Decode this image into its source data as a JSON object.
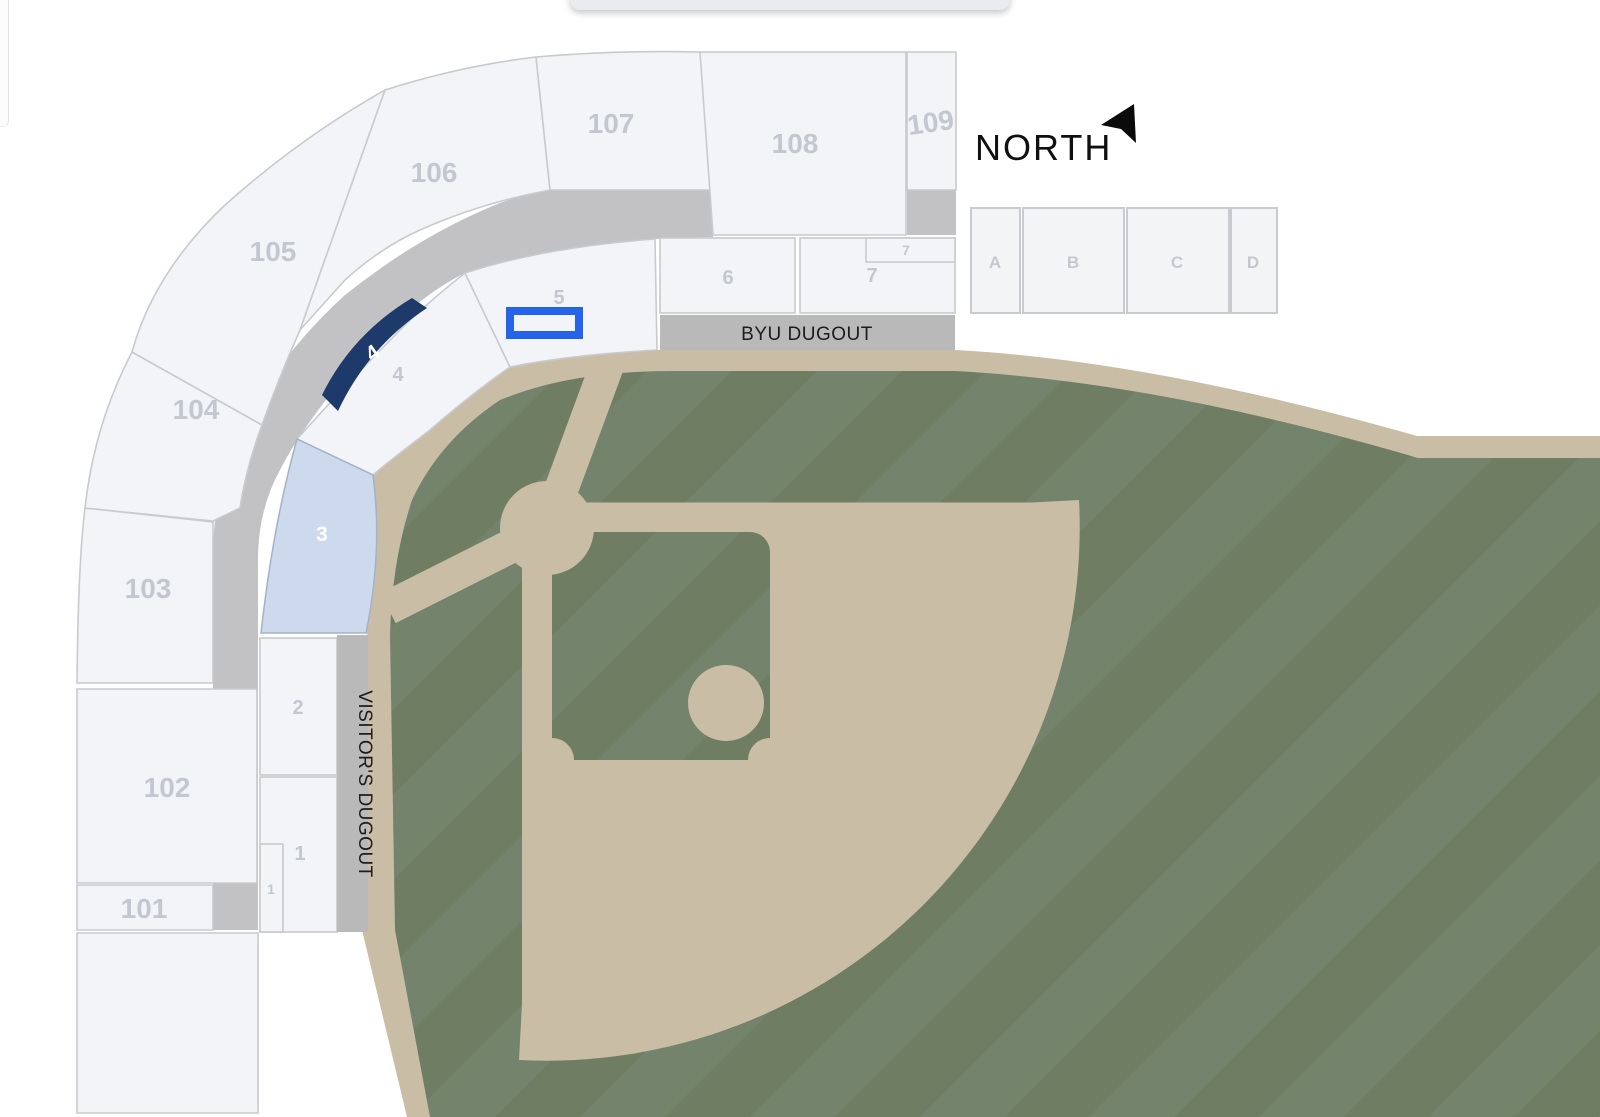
{
  "compass": {
    "label": "NORTH"
  },
  "dugouts": {
    "byu": "BYU DUGOUT",
    "visitor": "VISITOR'S DUGOUT"
  },
  "outer_sections": {
    "s101": "101",
    "s102": "102",
    "s103": "103",
    "s104": "104",
    "s105": "105",
    "s106": "106",
    "s107": "107",
    "s108": "108",
    "s109": "109"
  },
  "inner_sections": {
    "s1": "1",
    "s1_small": "1",
    "s2": "2",
    "s3": "3",
    "s4": "4",
    "s4_highlight": "4",
    "s5": "5",
    "s6": "6",
    "s7": "7",
    "s7_small": "7"
  },
  "suites": {
    "a": "A",
    "b": "B",
    "c": "C",
    "d": "D"
  },
  "colors": {
    "section_fill": "#f3f4f7",
    "section_border": "#c7cacf",
    "label_gray": "#c3c7cf",
    "walkway_gray": "#c2c2c4",
    "dugout_gray": "#b9b9ba",
    "grass_green": "#6f7e63",
    "grass_stripe": "#74836b",
    "dirt_tan": "#cabda5",
    "highlight_navy": "#1e3a6b",
    "highlight_lightblue": "#cdd9ec",
    "selection_blue": "#2563eb"
  }
}
